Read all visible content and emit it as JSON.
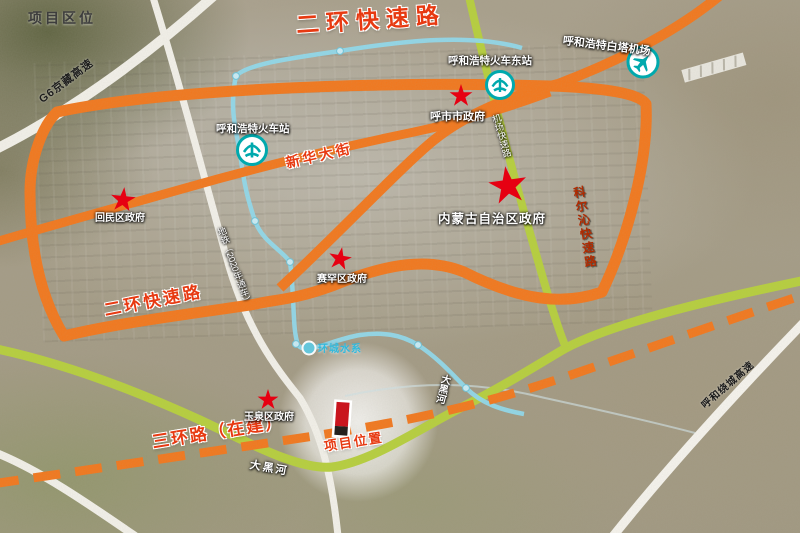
{
  "title": "项目区位",
  "legend_colors": {
    "expressway_orange": "#F2771C",
    "river_green": "#B6CF3C",
    "water_metro_cyan": "#8FD9EC",
    "highway_white": "#F3F1EA",
    "label_red": "#E73A12",
    "star_red": "#E60012",
    "transport_icon_teal": "#00A9AD"
  },
  "road_labels": {
    "erhuan_top": "二环快速路",
    "erhuan_sw": "二环快速路",
    "xinhua_street": "新华大街",
    "g6_expressway": "G6京藏高速",
    "keerqin_expressway": "科尔沁快速路",
    "sanhuan_under_construction": "三环路（在建）",
    "raocheng_expressway": "呼和绕城高速",
    "airport_expressway": "机场快速路",
    "metro_line": "地铁（2020年通车）",
    "daheihe_river_v": "大黑河",
    "daheihe_river_h": "大黑河",
    "ring_water": "环城水系"
  },
  "pois": {
    "hushi_government": "呼市市政府",
    "neimenggu_government": "内蒙古自治区政府",
    "huimin_government": "回民区政府",
    "saihan_government": "赛罕区政府",
    "yuquan_government": "玉泉区政府"
  },
  "stations": {
    "east_railway_station": "呼和浩特火车东站",
    "main_railway_station": "呼和浩特火车站",
    "airport": "呼和浩特白塔机场"
  },
  "project": {
    "location_label": "项目位置"
  }
}
